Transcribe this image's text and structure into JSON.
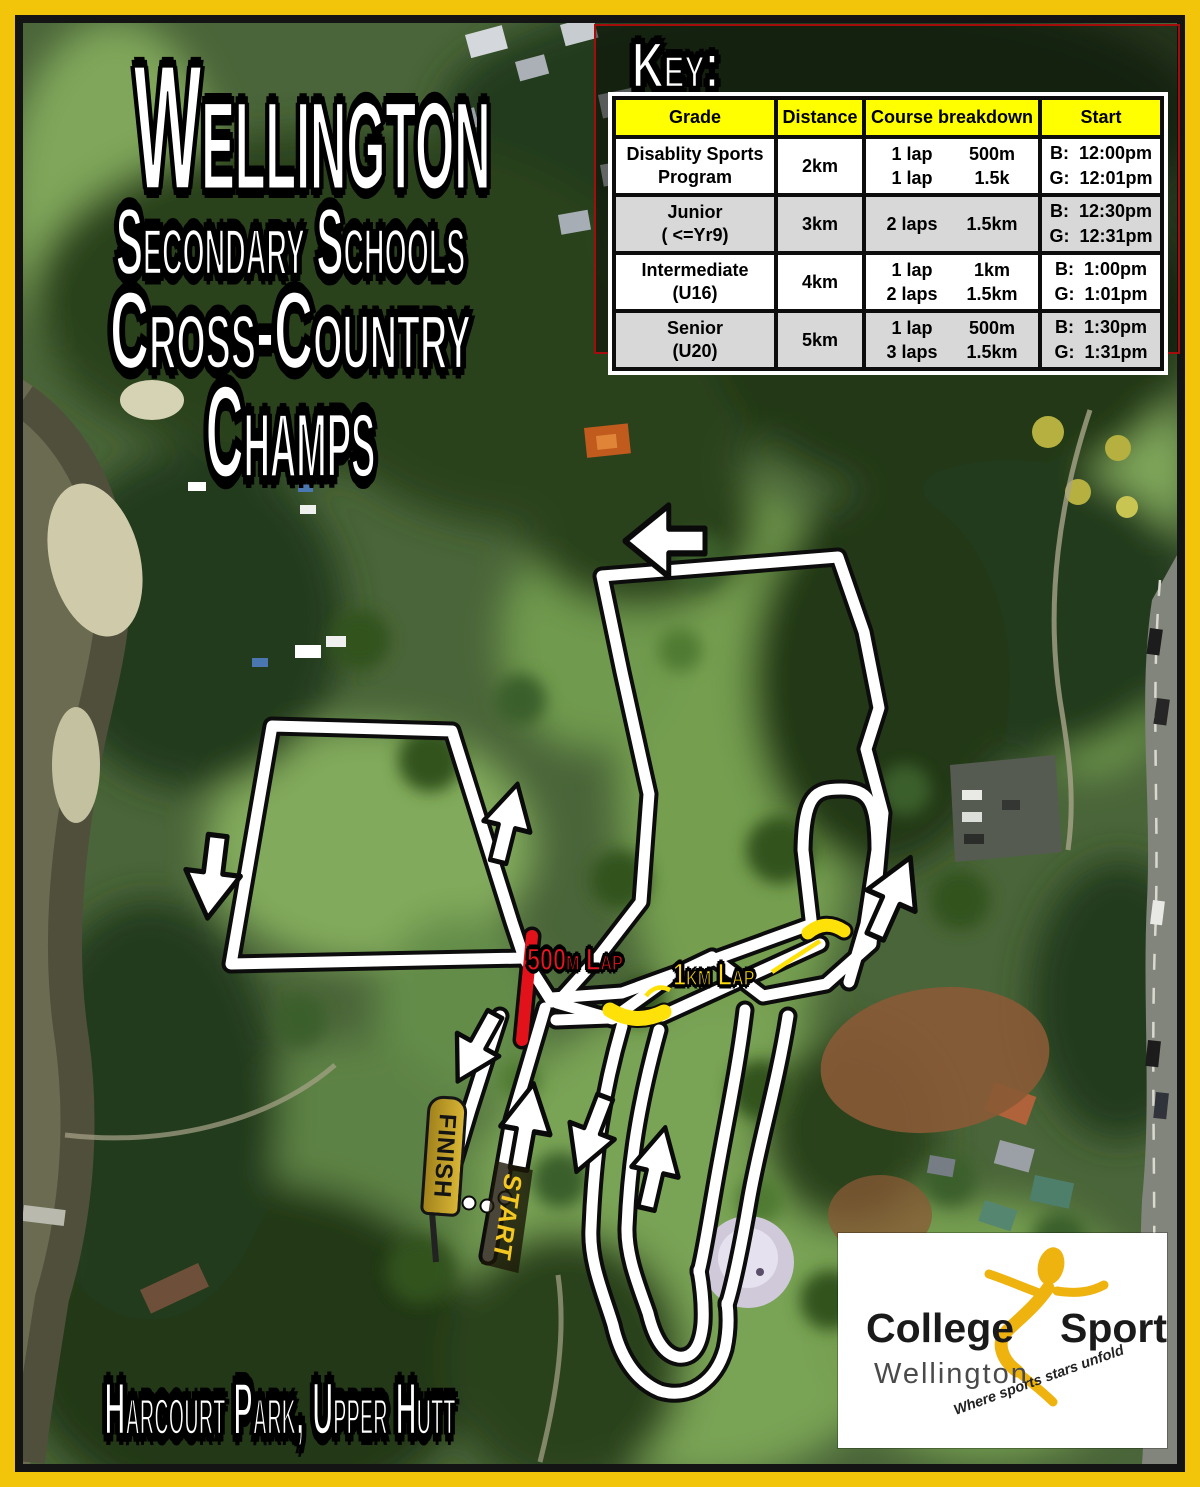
{
  "title": {
    "line1": "Wellington",
    "line2": "Secondary Schools",
    "line3": "Cross-Country",
    "line4": "Champs"
  },
  "location": "Harcourt Park, Upper Hutt",
  "key": {
    "heading": "Key:",
    "columns": [
      "Grade",
      "Distance",
      "Course breakdown",
      "Start"
    ],
    "rows": [
      {
        "grade": [
          "Disablity Sports",
          "Program"
        ],
        "distance": "2km",
        "breakdown": [
          [
            "1 lap",
            "500m"
          ],
          [
            "1 lap",
            "1.5k"
          ]
        ],
        "start": [
          [
            "B:",
            "12:00pm"
          ],
          [
            "G:",
            "12:01pm"
          ]
        ]
      },
      {
        "grade": [
          "Junior",
          "( <=Yr9)"
        ],
        "distance": "3km",
        "breakdown": [
          [
            "2 laps",
            "1.5km"
          ]
        ],
        "start": [
          [
            "B:",
            "12:30pm"
          ],
          [
            "G:",
            "12:31pm"
          ]
        ]
      },
      {
        "grade": [
          "Intermediate",
          "(U16)"
        ],
        "distance": "4km",
        "breakdown": [
          [
            "1 lap",
            "1km"
          ],
          [
            "2 laps",
            "1.5km"
          ]
        ],
        "start": [
          [
            "B:",
            "1:00pm"
          ],
          [
            "G:",
            "1:01pm"
          ]
        ]
      },
      {
        "grade": [
          "Senior",
          "(U20)"
        ],
        "distance": "5km",
        "breakdown": [
          [
            "1 lap",
            "500m"
          ],
          [
            "3 laps",
            "1.5km"
          ]
        ],
        "start": [
          [
            "B:",
            "1:30pm"
          ],
          [
            "G:",
            "1:31pm"
          ]
        ]
      }
    ]
  },
  "course": {
    "lap_500_label": "500m Lap",
    "lap_1km_label": "1km Lap",
    "start_label": "START",
    "finish_label": "FINISH",
    "colors": {
      "course_line": "#ffffff",
      "lap_500_segment": "#e2121b",
      "lap_1km_segment": "#ffe10a",
      "border": "#f2c50a",
      "key_header": "#ffff00"
    }
  },
  "logo": {
    "name_left": "College",
    "name_right": "Sport",
    "region": "Wellington",
    "tagline": "Where sports stars unfold",
    "figure_color": "#efb310"
  }
}
